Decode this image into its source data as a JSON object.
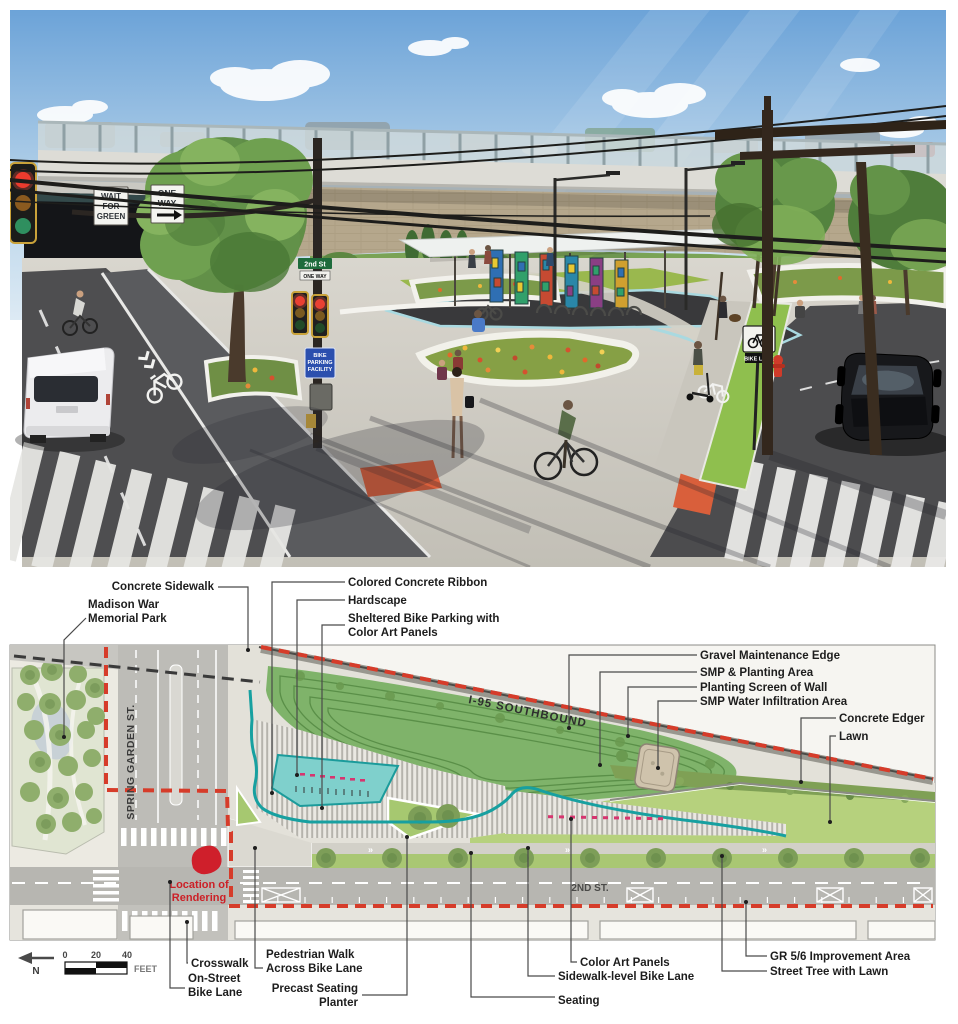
{
  "labels": {
    "concrete_sidewalk": "Concrete Sidewalk",
    "madison": "Madison War\nMemorial Park",
    "colored_ribbon": "Colored Concrete Ribbon",
    "hardscape": "Hardscape",
    "sheltered_bike": "Sheltered Bike Parking with\nColor Art Panels",
    "gravel_edge": "Gravel Maintenance Edge",
    "smp_planting": "SMP & Planting Area",
    "planting_screen": "Planting Screen of Wall",
    "smp_water": "SMP Water Infiltration Area",
    "concrete_edger": "Concrete Edger",
    "lawn": "Lawn",
    "crosswalk": "Crosswalk",
    "on_street": "On-Street\nBike Lane",
    "ped_walk": "Pedestrian Walk\nAcross Bike Lane",
    "precast": "Precast Seating\nPlanter",
    "seating": "Seating",
    "color_art": "Color Art Panels",
    "sidewalk_level": "Sidewalk-level Bike Lane",
    "gr56": "GR 5/6 Improvement Area",
    "street_tree": "Street Tree with Lawn"
  },
  "plan": {
    "streets": {
      "spring_garden": "SPRING GARDEN ST.",
      "second": "2ND ST.",
      "i95": "I-95 SOUTHBOUND"
    },
    "marker_line1": "Location of",
    "marker_line2": "Rendering",
    "scale": {
      "t0": "0",
      "t20": "20",
      "t40": "40",
      "unit": "FEET",
      "north": "N"
    }
  },
  "rendering": {
    "signs": {
      "wfg1": "WAIT",
      "wfg2": "FOR",
      "wfg3": "GREEN",
      "ow1": "ONE",
      "ow2": "WAY",
      "street": "2nd St",
      "one_way_small": "ONE WAY",
      "bike_lane": "BIKE LANE",
      "bp1": "BIKE",
      "bp2": "PARKING",
      "bp3": "FACILITY"
    }
  },
  "colors": {
    "boundary_red": "#d63c2a",
    "ribbon_teal": "#17a0a0",
    "marker_red": "#cc2027",
    "lawn_green": "#b6d17d",
    "smp_green": "#7fb36a",
    "accent_orange": "#d95f3b"
  }
}
